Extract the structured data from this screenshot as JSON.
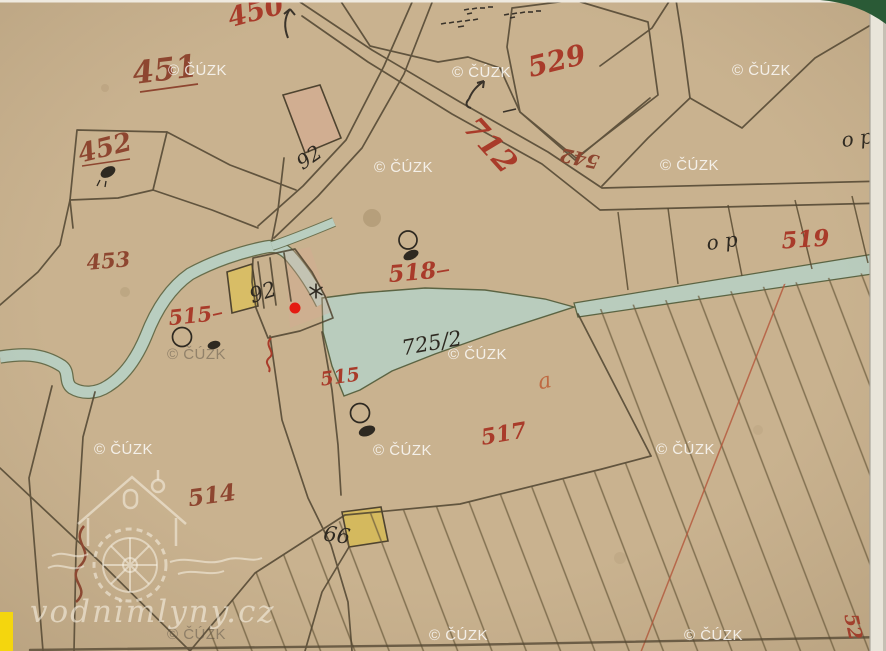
{
  "app": {
    "description": "historical cadastral map scan with location marker",
    "attribution": "© ČÚZK",
    "site": "vodnimlyny.cz"
  },
  "watermark": {
    "text": "© ČÚZK"
  },
  "branding": {
    "site": "vodnimlyny.cz"
  },
  "marker": {
    "shape": "red-dot",
    "color": "#e41a12"
  },
  "colors": {
    "paper": "#c9b28f",
    "water": "#b9cec0",
    "boundary_line": "#4f4430",
    "building_yellow": "#d8bd66",
    "building_pink": "#dba895",
    "edge_highlight_yellow": "#f4d60e",
    "corner_green": "#2a5a36",
    "red_label": "#a93b2a",
    "dark_red_label": "#8e4630",
    "ink_label": "#2e2921"
  },
  "labels": [
    {
      "text": "450",
      "color": "#a93b2a",
      "rotation": -15
    },
    {
      "text": "451",
      "color": "#8e4630",
      "rotation": -7
    },
    {
      "text": "452",
      "color": "#8e4630",
      "rotation": -14
    },
    {
      "text": "453",
      "color": "#8e4630",
      "rotation": -5
    },
    {
      "text": "529",
      "color": "#a93b2a",
      "rotation": -14
    },
    {
      "text": "712",
      "color": "#a93b2a",
      "rotation": 48
    },
    {
      "text": "542",
      "color": "#8e4630",
      "rotation": 192
    },
    {
      "text": "519",
      "color": "#a93b2a",
      "rotation": -4
    },
    {
      "text": "518",
      "color": "#a93b2a",
      "rotation": -5
    },
    {
      "text": "515",
      "color": "#a93b2a",
      "rotation": -6
    },
    {
      "text": "515",
      "color": "#a93b2a",
      "rotation": -8
    },
    {
      "text": "517",
      "color": "#a93b2a",
      "rotation": -10
    },
    {
      "text": "514",
      "color": "#8e4630",
      "rotation": -8
    },
    {
      "text": "52",
      "color": "#a93b2a",
      "rotation": 78
    },
    {
      "text": "92",
      "color": "#2e2921",
      "rotation": -35
    },
    {
      "text": "92",
      "color": "#2e2921",
      "rotation": -18
    },
    {
      "text": "99",
      "color": "#2e2921",
      "rotation": 188
    },
    {
      "text": "725/2",
      "color": "#2e2921",
      "rotation": -10
    },
    {
      "text": "o p",
      "color": "#2e2921",
      "rotation": -8
    },
    {
      "text": "o p",
      "color": "#2e2921",
      "rotation": -8
    },
    {
      "text": "a",
      "color": "#bf6a42",
      "rotation": -12
    }
  ]
}
